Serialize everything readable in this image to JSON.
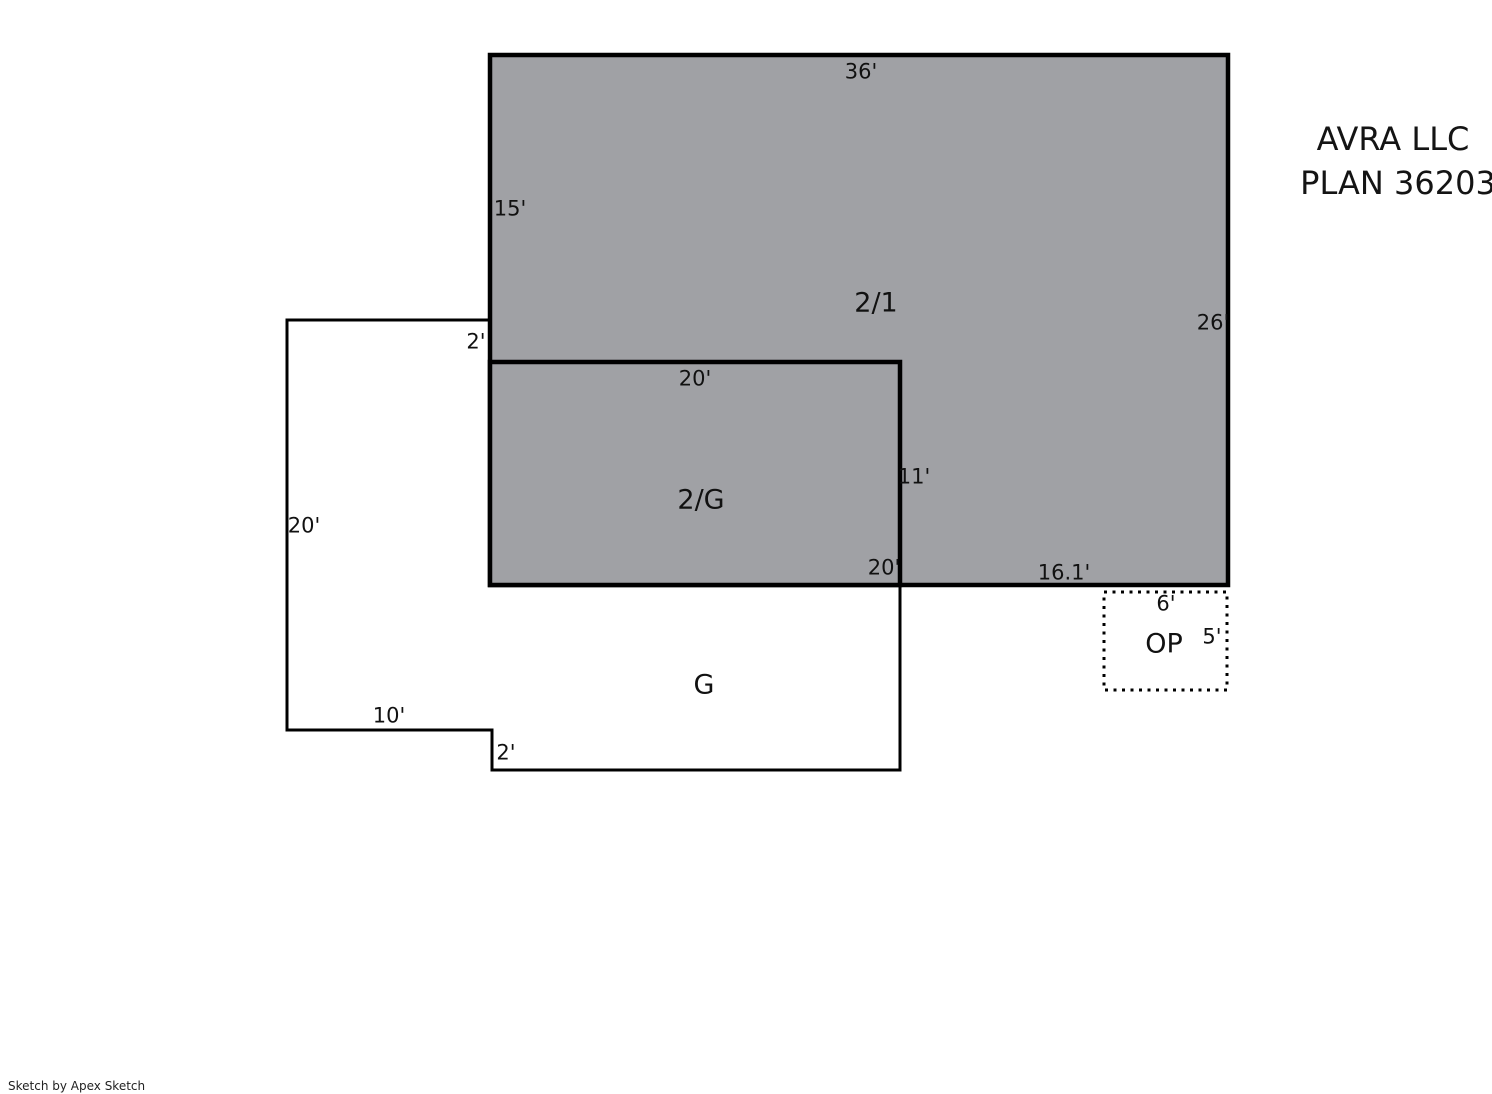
{
  "plan": {
    "title_line1": "AVRA LLC",
    "title_line2": "PLAN 36203"
  },
  "footer": {
    "credit": "Sketch by Apex Sketch"
  },
  "colors": {
    "two_story_fill": "#a0a1a5",
    "garage_fill": "#ffffff",
    "line": "#000000"
  },
  "areas": {
    "upper_two_story": "2/1",
    "two_over_garage": "2/G",
    "garage": "G",
    "open_porch": "OP"
  },
  "dimensions": {
    "d36": "36'",
    "d15": "15'",
    "d26": "26'",
    "d2_upper": "2'",
    "d20_top": "20'",
    "d20_left": "20'",
    "d11": "11'",
    "d20_bottom": "20'",
    "d16_1": "16.1'",
    "d6": "6'",
    "d5": "5'",
    "d10": "10'",
    "d2_lower": "2'"
  }
}
